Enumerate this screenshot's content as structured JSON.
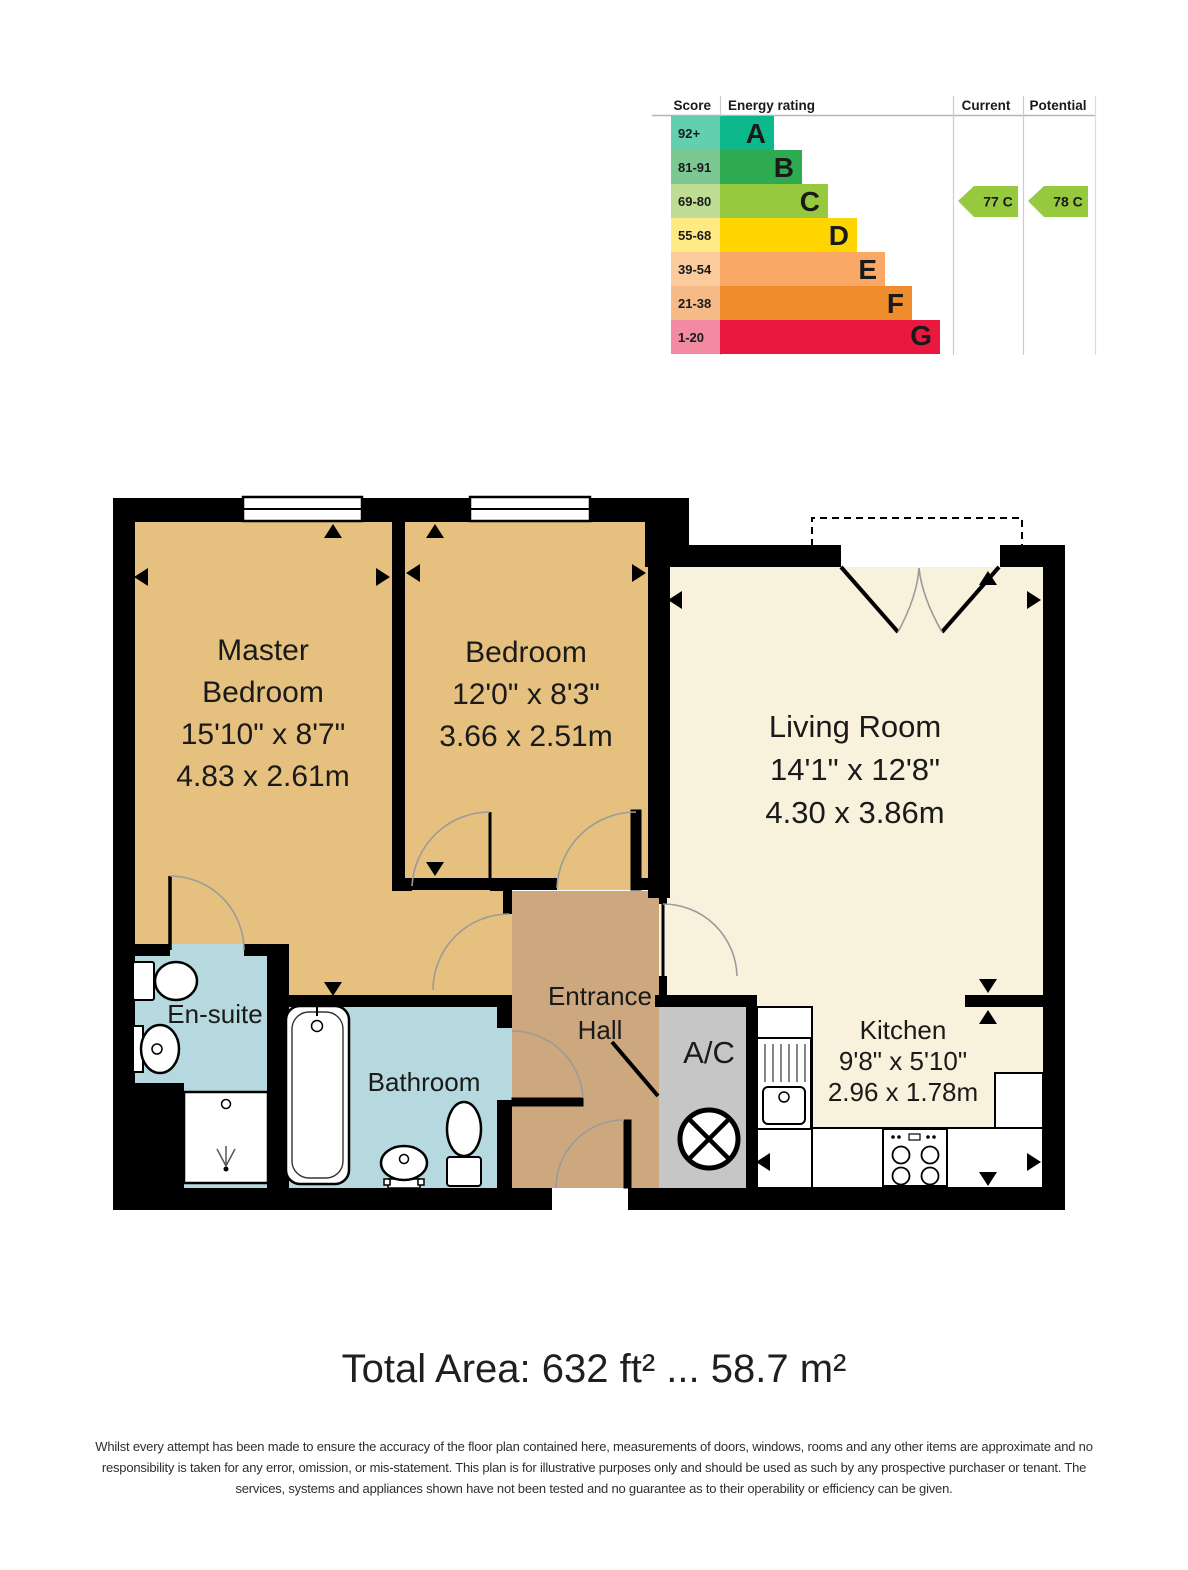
{
  "epc": {
    "headers": {
      "score": "Score",
      "rating": "Energy rating",
      "current": "Current",
      "potential": "Potential"
    },
    "rows": [
      {
        "score": "92+",
        "letter": "A",
        "bar_w": 54,
        "letter_x": 766,
        "bar": "#0db98c",
        "cell": "#62cfae"
      },
      {
        "score": "81-91",
        "letter": "B",
        "bar_w": 82,
        "letter_x": 794,
        "bar": "#2eab50",
        "cell": "#7cc893"
      },
      {
        "score": "69-80",
        "letter": "C",
        "bar_w": 108,
        "letter_x": 820,
        "bar": "#96c93e",
        "cell": "#bedc92"
      },
      {
        "score": "55-68",
        "letter": "D",
        "bar_w": 137,
        "letter_x": 849,
        "bar": "#ffd500",
        "cell": "#ffe982"
      },
      {
        "score": "39-54",
        "letter": "E",
        "bar_w": 165,
        "letter_x": 877,
        "bar": "#f9a965",
        "cell": "#fbcb9e"
      },
      {
        "score": "21-38",
        "letter": "F",
        "bar_w": 192,
        "letter_x": 904,
        "bar": "#ef8c2c",
        "cell": "#f5ba85"
      },
      {
        "score": "1-20",
        "letter": "G",
        "bar_w": 220,
        "letter_x": 932,
        "bar": "#e9183f",
        "cell": "#f28aa1"
      }
    ],
    "current": {
      "label": "77 C",
      "color": "#96c93e"
    },
    "potential": {
      "label": "78 C",
      "color": "#96c93e"
    }
  },
  "rooms": {
    "master": [
      "Master",
      "Bedroom",
      "15'10\" x 8'7\"",
      "4.83 x 2.61m"
    ],
    "bedroom": [
      "Bedroom",
      "12'0\" x 8'3\"",
      "3.66 x 2.51m"
    ],
    "living": [
      "Living Room",
      "14'1\" x 12'8\"",
      "4.30 x 3.86m"
    ],
    "kitchen": [
      "Kitchen",
      "9'8\" x 5'10\"",
      "2.96 x 1.78m"
    ],
    "hall": [
      "Entrance",
      "Hall"
    ],
    "ensuite": "En-suite",
    "bathroom": "Bathroom",
    "ac": "A/C"
  },
  "colors": {
    "bedroom": "#e5c07e",
    "living": "#f8f1dc",
    "hall": "#cda77e",
    "wet": "#b5d9de",
    "ac": "#c6c6c6",
    "wall": "#000000"
  },
  "total_area": "Total Area: 632 ft² ... 58.7 m²",
  "disclaimer": [
    "Whilst every attempt has been made to ensure the accuracy of the floor plan contained here, measurements of doors, windows, rooms and any other items are approximate and no",
    "responsibility is taken for any error, omission, or mis-statement. This plan is for illustrative purposes only and should be used as such by any prospective purchaser or tenant. The",
    "services, systems and appliances shown have not been tested and no guarantee as to their operability or efficiency can be given."
  ]
}
